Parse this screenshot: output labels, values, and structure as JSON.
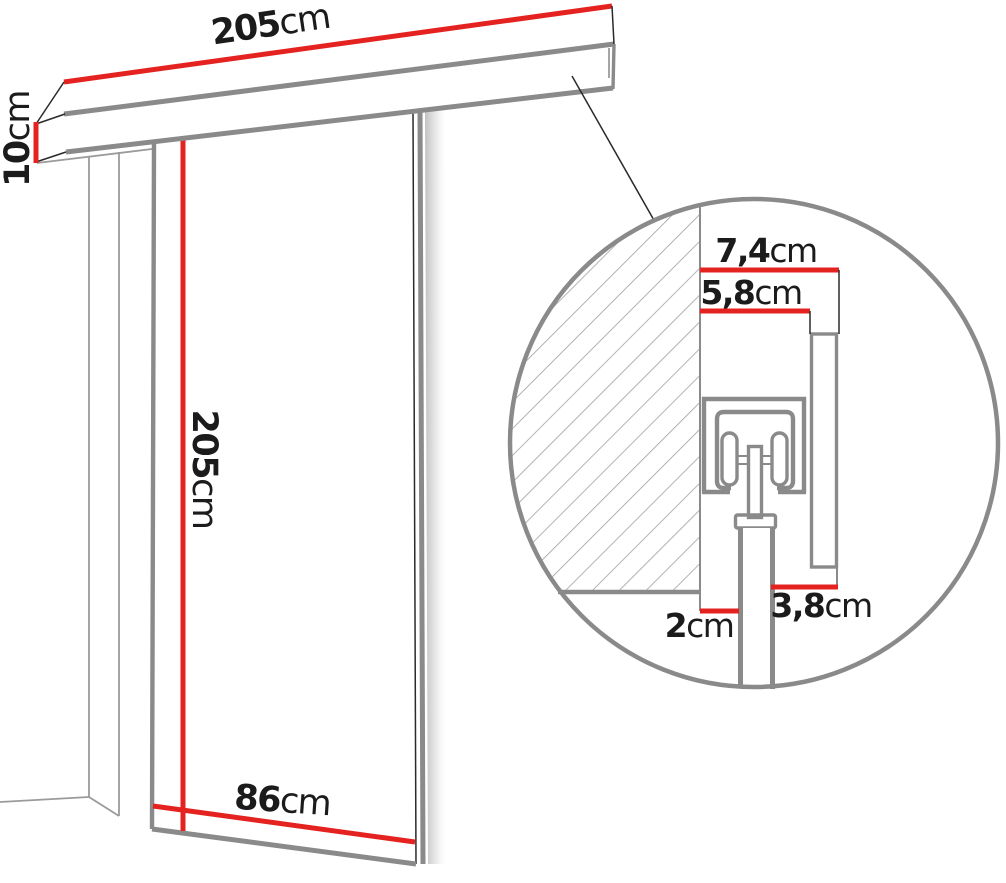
{
  "diagram": {
    "title": "sliding-door-system-dimension-diagram",
    "colors": {
      "dimension_line_red": "#e42320",
      "outline_gray": "#8a8a8a",
      "hatch_gray": "#9a9a9a",
      "text_black": "#1b1b1b"
    },
    "labels": {
      "rail_length": {
        "value": "205",
        "unit": "cm"
      },
      "rail_height": {
        "value": "10",
        "unit": "cm"
      },
      "door_height": {
        "value": "205",
        "unit": "cm"
      },
      "door_width": {
        "value": "86",
        "unit": "cm"
      },
      "detail_total_depth": {
        "value": "7,4",
        "unit": "cm"
      },
      "detail_track_depth": {
        "value": "5,8",
        "unit": "cm"
      },
      "detail_door_to_fascia": {
        "value": "3,8",
        "unit": "cm"
      },
      "detail_wall_to_door": {
        "value": "2",
        "unit": "cm"
      }
    }
  }
}
